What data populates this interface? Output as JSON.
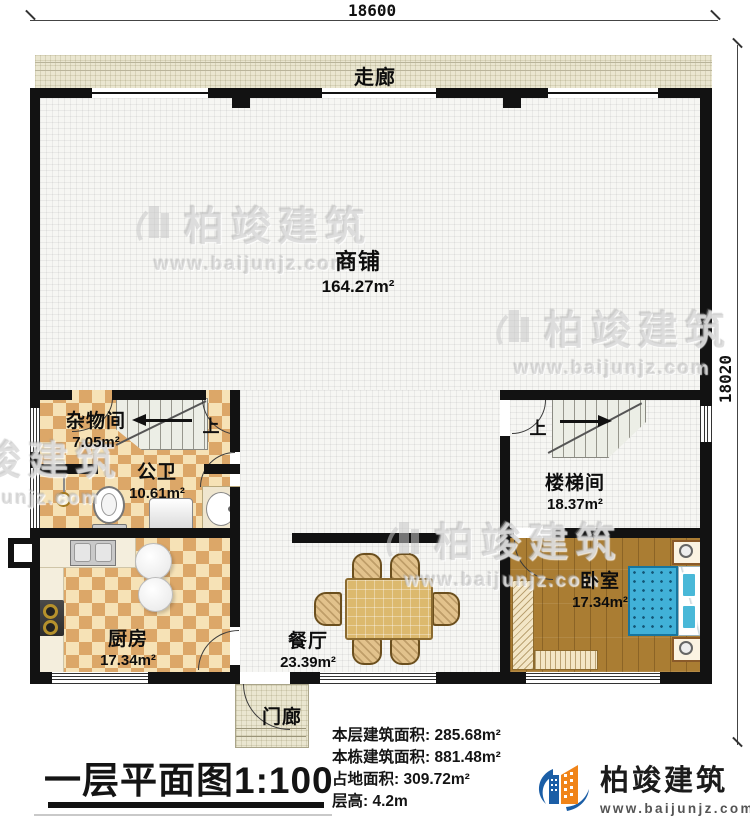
{
  "dimensions": {
    "top": "18600",
    "right": "18020"
  },
  "rooms": [
    {
      "id": "corridor",
      "name": "走廊",
      "area": ""
    },
    {
      "id": "shop",
      "name": "商铺",
      "area": "164.27m²"
    },
    {
      "id": "storage",
      "name": "杂物间",
      "area": "7.05m²"
    },
    {
      "id": "bathroom",
      "name": "公卫",
      "area": "10.61m²"
    },
    {
      "id": "kitchen",
      "name": "厨房",
      "area": "17.34m²"
    },
    {
      "id": "dining",
      "name": "餐厅",
      "area": "23.39m²"
    },
    {
      "id": "stairwell",
      "name": "楼梯间",
      "area": "18.37m²"
    },
    {
      "id": "bedroom",
      "name": "卧室",
      "area": "17.34m²"
    },
    {
      "id": "porch",
      "name": "门廊",
      "area": ""
    }
  ],
  "stairs": {
    "up_label": "上"
  },
  "title": {
    "full": "一层平面图1:100"
  },
  "stats": [
    {
      "label": "本层建筑面积",
      "value": "285.68m²",
      "text": "本层建筑面积: 285.68m²"
    },
    {
      "label": "本栋建筑面积",
      "value": "881.48m²",
      "text": "本栋建筑面积: 881.48m²"
    },
    {
      "label": "占地面积",
      "value": "309.72m²",
      "text": "占地面积: 309.72m²"
    },
    {
      "label": "层高",
      "value": "4.2m",
      "text": "层高: 4.2m"
    }
  ],
  "brand": {
    "name": "柏竣建筑",
    "url": "www.baijunjz.com"
  },
  "colors": {
    "wall": "#121212",
    "checker_dark": "#dca768",
    "checker_light": "#f6e2b6",
    "wood": "#aa7d33",
    "bed_blue": "#41b1d8",
    "corridor": "#eae6d0",
    "logo_blue": "#1b5ea6",
    "logo_orange": "#f08419"
  }
}
